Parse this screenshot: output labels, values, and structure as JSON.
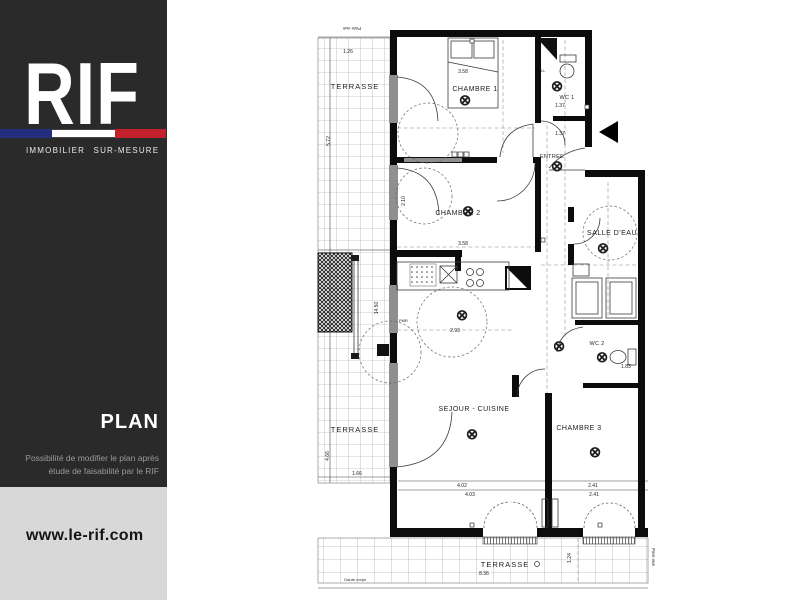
{
  "sidebar": {
    "logo_text": "RIF",
    "tagline": "IMMOBILIER SUR-MESURE",
    "section_label": "PLAN",
    "note_line1": "Possibilité de modifier le plan après",
    "note_line2": "étude de faisabilité par le RIF",
    "website": "www.le-rif.com",
    "colors": {
      "background": "#2b2a2a",
      "flag_blue": "#252e7c",
      "flag_white": "#ffffff",
      "flag_red": "#c2202d",
      "footer_background": "#d8d8d8"
    }
  },
  "plan": {
    "rooms": [
      {
        "label": "CHAMBRE 1"
      },
      {
        "label": "WC 1"
      },
      {
        "label": "ENTREE"
      },
      {
        "label": "CHAMBRE 2"
      },
      {
        "label": "SALLE D'EAU"
      },
      {
        "label": "SEJOUR - CUISINE"
      },
      {
        "label": "WC 2"
      },
      {
        "label": "CHAMBRE 3"
      },
      {
        "label": "TERRASSE"
      },
      {
        "label": "TERRASSE"
      },
      {
        "label": "TERRASSE"
      }
    ],
    "dimensions": [
      "1.26",
      "5.72",
      "3.58",
      "3.58",
      "2.93",
      "14.50",
      "4.66",
      "1.66",
      "4.02",
      "4.03",
      "2.41",
      "2.41",
      "8.36",
      "1.24",
      "1.83",
      "1.37",
      "1.37",
      "2.10"
    ],
    "annotations": {
      "pare_vue": "Pare vue",
      "garde_corps": "Garde corps",
      "pmr": "PMR",
      "ll": "LL"
    },
    "symbols": {
      "ceiling_light": "⊗"
    }
  }
}
